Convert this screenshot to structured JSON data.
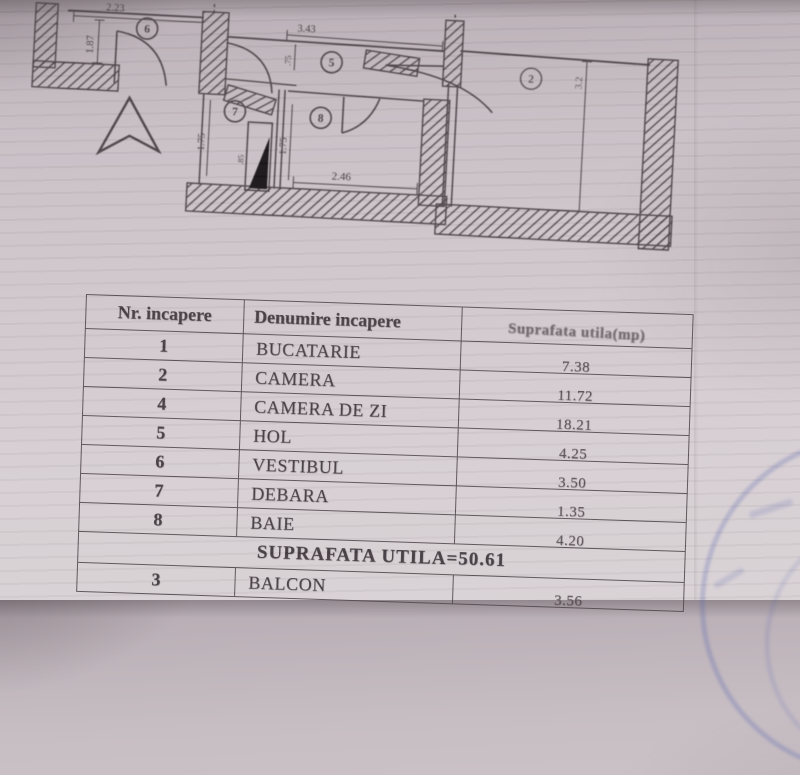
{
  "floor_plan": {
    "rooms": {
      "vestibul": "6",
      "hol": "5",
      "debara": "7",
      "baie": "8",
      "camera": "2"
    },
    "dimensions": {
      "top_width": "2.23",
      "left_height": "1.87",
      "hol_width": "3.43",
      "hol_depth": ".75",
      "debara_height": "1.75",
      "baie_height": "1.75",
      "baie_width": "2.46",
      "shaft_width": ".85",
      "camera_height": "3.2"
    }
  },
  "table": {
    "headers": [
      "Nr. incapere",
      "Denumire incapere",
      "Suprafata utila(mp)"
    ],
    "rows": [
      {
        "nr": "1",
        "name": "BUCATARIE",
        "value": "7.38"
      },
      {
        "nr": "2",
        "name": "CAMERA",
        "value": "11.72"
      },
      {
        "nr": "4",
        "name": "CAMERA DE ZI",
        "value": "18.21"
      },
      {
        "nr": "5",
        "name": "HOL",
        "value": "4.25"
      },
      {
        "nr": "6",
        "name": "VESTIBUL",
        "value": "3.50"
      },
      {
        "nr": "7",
        "name": "DEBARA",
        "value": "1.35"
      },
      {
        "nr": "8",
        "name": "BAIE",
        "value": "4.20"
      }
    ],
    "summary": "SUPRAFATA UTILA=50.61",
    "balcon_row": {
      "nr": "3",
      "name": "BALCON",
      "value": "3.56"
    }
  }
}
